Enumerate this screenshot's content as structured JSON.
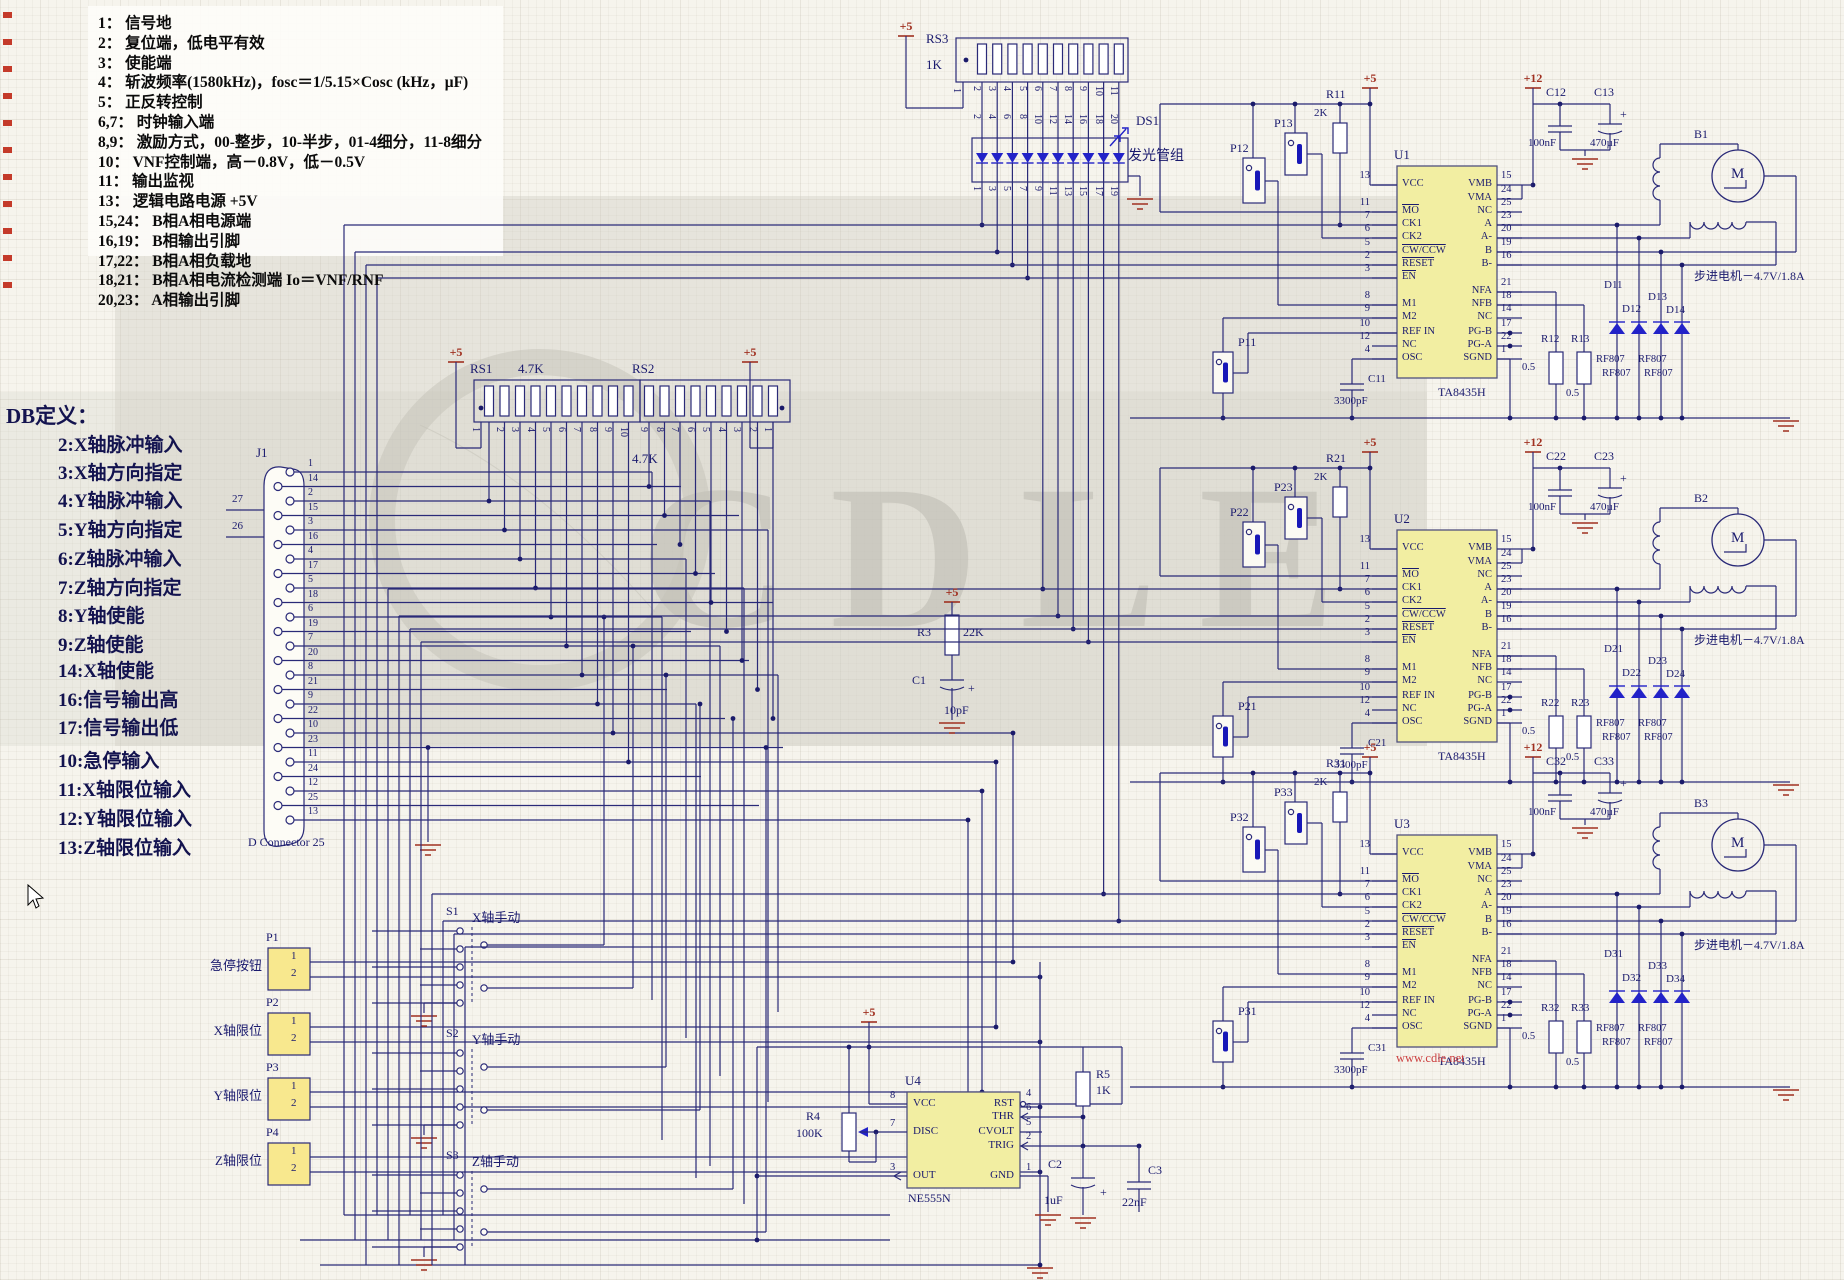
{
  "notes": {
    "lines": [
      "1： 信号地",
      "2： 复位端，低电平有效",
      "3： 使能端",
      "4： 斩波频率(1580kHz)，fosc＝1/5.15×Cosc  (kHz，μF)",
      "5： 正反转控制",
      "6,7： 时钟输入端",
      "8,9： 激励方式，00-整步，10-半步，01-4细分，11-8细分",
      "10： VNF控制端，高－0.8V，低－0.5V",
      "11： 输出监视",
      "13： 逻辑电路电源 +5V",
      "15,24： B相A相电源端",
      "16,19： B相输出引脚",
      "17,22： B相A相负载地",
      "18,21： B相A相电流检测端 Io＝VNF/RNF",
      "20,23： A相输出引脚"
    ]
  },
  "db": {
    "title": "DB定义：",
    "items": [
      "2:X轴脉冲输入",
      "3:X轴方向指定",
      "4:Y轴脉冲输入",
      "5:Y轴方向指定",
      "6:Z轴脉冲输入",
      "7:Z轴方向指定",
      "8:Y轴使能",
      "9:Z轴使能",
      "14:X轴使能",
      "16:信号输出高",
      "17:信号输出低",
      "10:急停输入",
      "11:X轴限位输入",
      "12:Y轴限位输入",
      "13:Z轴限位输入"
    ]
  },
  "j1": {
    "ref": "J1",
    "caption": "D Connector 25",
    "shell_pins": [
      "27",
      "26"
    ],
    "pins": [
      "1",
      "14",
      "2",
      "15",
      "3",
      "16",
      "4",
      "17",
      "5",
      "18",
      "6",
      "19",
      "7",
      "20",
      "8",
      "21",
      "9",
      "22",
      "10",
      "23",
      "11",
      "24",
      "12",
      "25",
      "13"
    ]
  },
  "rs1": {
    "ref": "RS1",
    "value": "4.7K",
    "pins": [
      "1",
      "2",
      "3",
      "4",
      "5",
      "6",
      "7",
      "8",
      "9",
      "10"
    ]
  },
  "rs2": {
    "ref": "RS2",
    "value": "4.7K",
    "pins": [
      "9",
      "8",
      "7",
      "6",
      "5",
      "4",
      "3",
      "2",
      "1"
    ]
  },
  "rs3": {
    "ref": "RS3",
    "value": "1K",
    "pins_top": [
      "1",
      "2",
      "3",
      "4",
      "5",
      "6",
      "7",
      "8",
      "9",
      "10",
      "11"
    ],
    "pins_mid": [
      "2",
      "4",
      "6",
      "8",
      "10",
      "12",
      "14",
      "16",
      "18",
      "20"
    ]
  },
  "ds1": {
    "ref": "DS1",
    "caption": "发光管组",
    "pins": [
      "1",
      "3",
      "5",
      "7",
      "9",
      "11",
      "13",
      "15",
      "17",
      "19"
    ]
  },
  "power": {
    "p5": "+5",
    "p12": "+12"
  },
  "mid": {
    "r3": {
      "ref": "R3",
      "value": "22K"
    },
    "c1": {
      "ref": "C1",
      "value": "10pF",
      "plus": "+"
    }
  },
  "timer": {
    "ref": "U4",
    "part": "NE555N",
    "pins_left": [
      {
        "n": "8",
        "t": "VCC"
      },
      {
        "n": "7",
        "t": "DISC"
      },
      {
        "n": "3",
        "t": "OUT"
      }
    ],
    "pins_right": [
      {
        "n": "4",
        "t": "RST"
      },
      {
        "n": "6",
        "t": "THR"
      },
      {
        "n": "5",
        "t": "CVOLT"
      },
      {
        "n": "2",
        "t": "TRIG"
      },
      {
        "n": "1",
        "t": "GND"
      }
    ],
    "r4": {
      "ref": "R4",
      "value": "100K"
    },
    "r5": {
      "ref": "R5",
      "value": "1K"
    },
    "c2": {
      "ref": "C2",
      "value": "1uF",
      "plus": "+"
    },
    "c3": {
      "ref": "C3",
      "value": "22nF"
    }
  },
  "connectors": [
    {
      "ref": "P1",
      "caption": "急停按钮",
      "pins": [
        "1",
        "2"
      ]
    },
    {
      "ref": "P2",
      "caption": "X轴限位",
      "pins": [
        "1",
        "2"
      ]
    },
    {
      "ref": "P3",
      "caption": "Y轴限位",
      "pins": [
        "1",
        "2"
      ]
    },
    {
      "ref": "P4",
      "caption": "Z轴限位",
      "pins": [
        "1",
        "2"
      ]
    }
  ],
  "switches": [
    {
      "ref": "S1",
      "caption": "X轴手动"
    },
    {
      "ref": "S2",
      "caption": "Y轴手动"
    },
    {
      "ref": "S3",
      "caption": "Z轴手动"
    }
  ],
  "drivers": [
    {
      "ref": "U1",
      "part": "TA8435H",
      "pins_left": [
        {
          "n": "13",
          "t": "VCC"
        },
        {
          "n": "11",
          "t": "MO",
          "bar": true
        },
        {
          "n": "7",
          "t": "CK1"
        },
        {
          "n": "6",
          "t": "CK2"
        },
        {
          "n": "5",
          "t": "CW/CCW",
          "bar": true
        },
        {
          "n": "2",
          "t": "RESET",
          "bar": true
        },
        {
          "n": "3",
          "t": "EN",
          "bar": true
        },
        {
          "n": "8",
          "t": "M1"
        },
        {
          "n": "9",
          "t": "M2"
        },
        {
          "n": "10",
          "t": "REF IN"
        },
        {
          "n": "12",
          "t": "NC"
        },
        {
          "n": "4",
          "t": "OSC"
        }
      ],
      "pins_right": [
        {
          "n": "15",
          "t": "VMB"
        },
        {
          "n": "24",
          "t": "VMA"
        },
        {
          "n": "25",
          "t": "NC"
        },
        {
          "n": "23",
          "t": "A"
        },
        {
          "n": "20",
          "t": "A-"
        },
        {
          "n": "19",
          "t": "B"
        },
        {
          "n": "16",
          "t": "B-"
        },
        {
          "n": "21",
          "t": "NFA"
        },
        {
          "n": "18",
          "t": "NFB"
        },
        {
          "n": "14",
          "t": "NC"
        },
        {
          "n": "17",
          "t": "PG-B"
        },
        {
          "n": "22",
          "t": "PG-A"
        },
        {
          "n": "1",
          "t": "SGND"
        }
      ],
      "jumpers": {
        "a": "P11",
        "b": "P12",
        "c": "P13"
      },
      "pullup": {
        "ref": "R11",
        "value": "2K"
      },
      "cap_a": {
        "ref": "C12",
        "value": "100nF"
      },
      "cap_b": {
        "ref": "C13",
        "value": "470µF",
        "plus": "+"
      },
      "osc_cap": {
        "ref": "C11",
        "value": "3300pF"
      },
      "sense": [
        {
          "ref": "R12",
          "value": "0.5"
        },
        {
          "ref": "R13",
          "value": "0.5"
        }
      ],
      "diodes": [
        {
          "ref": "D11",
          "part": "RF807"
        },
        {
          "ref": "D12",
          "part": "RF807"
        },
        {
          "ref": "D13",
          "part": "RF807"
        },
        {
          "ref": "D14",
          "part": "RF807"
        }
      ],
      "motor": {
        "ref": "B1",
        "sym": "M",
        "caption": "步进电机－4.7V/1.8A"
      }
    },
    {
      "ref": "U2",
      "part": "TA8435H",
      "pins_left": [
        {
          "n": "13",
          "t": "VCC"
        },
        {
          "n": "11",
          "t": "MO",
          "bar": true
        },
        {
          "n": "7",
          "t": "CK1"
        },
        {
          "n": "6",
          "t": "CK2"
        },
        {
          "n": "5",
          "t": "CW/CCW",
          "bar": true
        },
        {
          "n": "2",
          "t": "RESET",
          "bar": true
        },
        {
          "n": "3",
          "t": "EN",
          "bar": true
        },
        {
          "n": "8",
          "t": "M1"
        },
        {
          "n": "9",
          "t": "M2"
        },
        {
          "n": "10",
          "t": "REF IN"
        },
        {
          "n": "12",
          "t": "NC"
        },
        {
          "n": "4",
          "t": "OSC"
        }
      ],
      "pins_right": [
        {
          "n": "15",
          "t": "VMB"
        },
        {
          "n": "24",
          "t": "VMA"
        },
        {
          "n": "25",
          "t": "NC"
        },
        {
          "n": "23",
          "t": "A"
        },
        {
          "n": "20",
          "t": "A-"
        },
        {
          "n": "19",
          "t": "B"
        },
        {
          "n": "16",
          "t": "B-"
        },
        {
          "n": "21",
          "t": "NFA"
        },
        {
          "n": "18",
          "t": "NFB"
        },
        {
          "n": "14",
          "t": "NC"
        },
        {
          "n": "17",
          "t": "PG-B"
        },
        {
          "n": "22",
          "t": "PG-A"
        },
        {
          "n": "1",
          "t": "SGND"
        }
      ],
      "jumpers": {
        "a": "P21",
        "b": "P22",
        "c": "P23"
      },
      "pullup": {
        "ref": "R21",
        "value": "2K"
      },
      "cap_a": {
        "ref": "C22",
        "value": "100nF"
      },
      "cap_b": {
        "ref": "C23",
        "value": "470µF",
        "plus": "+"
      },
      "osc_cap": {
        "ref": "C21",
        "value": "3300pF"
      },
      "sense": [
        {
          "ref": "R22",
          "value": "0.5"
        },
        {
          "ref": "R23",
          "value": "0.5"
        }
      ],
      "diodes": [
        {
          "ref": "D21",
          "part": "RF807"
        },
        {
          "ref": "D22",
          "part": "RF807"
        },
        {
          "ref": "D23",
          "part": "RF807"
        },
        {
          "ref": "D24",
          "part": "RF807"
        }
      ],
      "motor": {
        "ref": "B2",
        "sym": "M",
        "caption": "步进电机－4.7V/1.8A"
      }
    },
    {
      "ref": "U3",
      "part": "TA8435H",
      "pins_left": [
        {
          "n": "13",
          "t": "VCC"
        },
        {
          "n": "11",
          "t": "MO",
          "bar": true
        },
        {
          "n": "7",
          "t": "CK1"
        },
        {
          "n": "6",
          "t": "CK2"
        },
        {
          "n": "5",
          "t": "CW/CCW",
          "bar": true
        },
        {
          "n": "2",
          "t": "RESET",
          "bar": true
        },
        {
          "n": "3",
          "t": "EN",
          "bar": true
        },
        {
          "n": "8",
          "t": "M1"
        },
        {
          "n": "9",
          "t": "M2"
        },
        {
          "n": "10",
          "t": "REF IN"
        },
        {
          "n": "12",
          "t": "NC"
        },
        {
          "n": "4",
          "t": "OSC"
        }
      ],
      "pins_right": [
        {
          "n": "15",
          "t": "VMB"
        },
        {
          "n": "24",
          "t": "VMA"
        },
        {
          "n": "25",
          "t": "NC"
        },
        {
          "n": "23",
          "t": "A"
        },
        {
          "n": "20",
          "t": "A-"
        },
        {
          "n": "19",
          "t": "B"
        },
        {
          "n": "16",
          "t": "B-"
        },
        {
          "n": "21",
          "t": "NFA"
        },
        {
          "n": "18",
          "t": "NFB"
        },
        {
          "n": "14",
          "t": "NC"
        },
        {
          "n": "17",
          "t": "PG-B"
        },
        {
          "n": "22",
          "t": "PG-A"
        },
        {
          "n": "1",
          "t": "SGND"
        }
      ],
      "jumpers": {
        "a": "P31",
        "b": "P32",
        "c": "P33"
      },
      "pullup": {
        "ref": "R31",
        "value": "2K"
      },
      "cap_a": {
        "ref": "C32",
        "value": "100nF"
      },
      "cap_b": {
        "ref": "C33",
        "value": "470µF",
        "plus": "+"
      },
      "osc_cap": {
        "ref": "C31",
        "value": "3300pF"
      },
      "sense": [
        {
          "ref": "R32",
          "value": "0.5"
        },
        {
          "ref": "R33",
          "value": "0.5"
        }
      ],
      "diodes": [
        {
          "ref": "D31",
          "part": "RF807"
        },
        {
          "ref": "D32",
          "part": "RF807"
        },
        {
          "ref": "D33",
          "part": "RF807"
        },
        {
          "ref": "D34",
          "part": "RF807"
        }
      ],
      "motor": {
        "ref": "B3",
        "sym": "M",
        "caption": "步进电机－4.7V/1.8A"
      }
    }
  ],
  "watermark": {
    "text": "CDLE",
    "site": "www.cdle.net"
  }
}
